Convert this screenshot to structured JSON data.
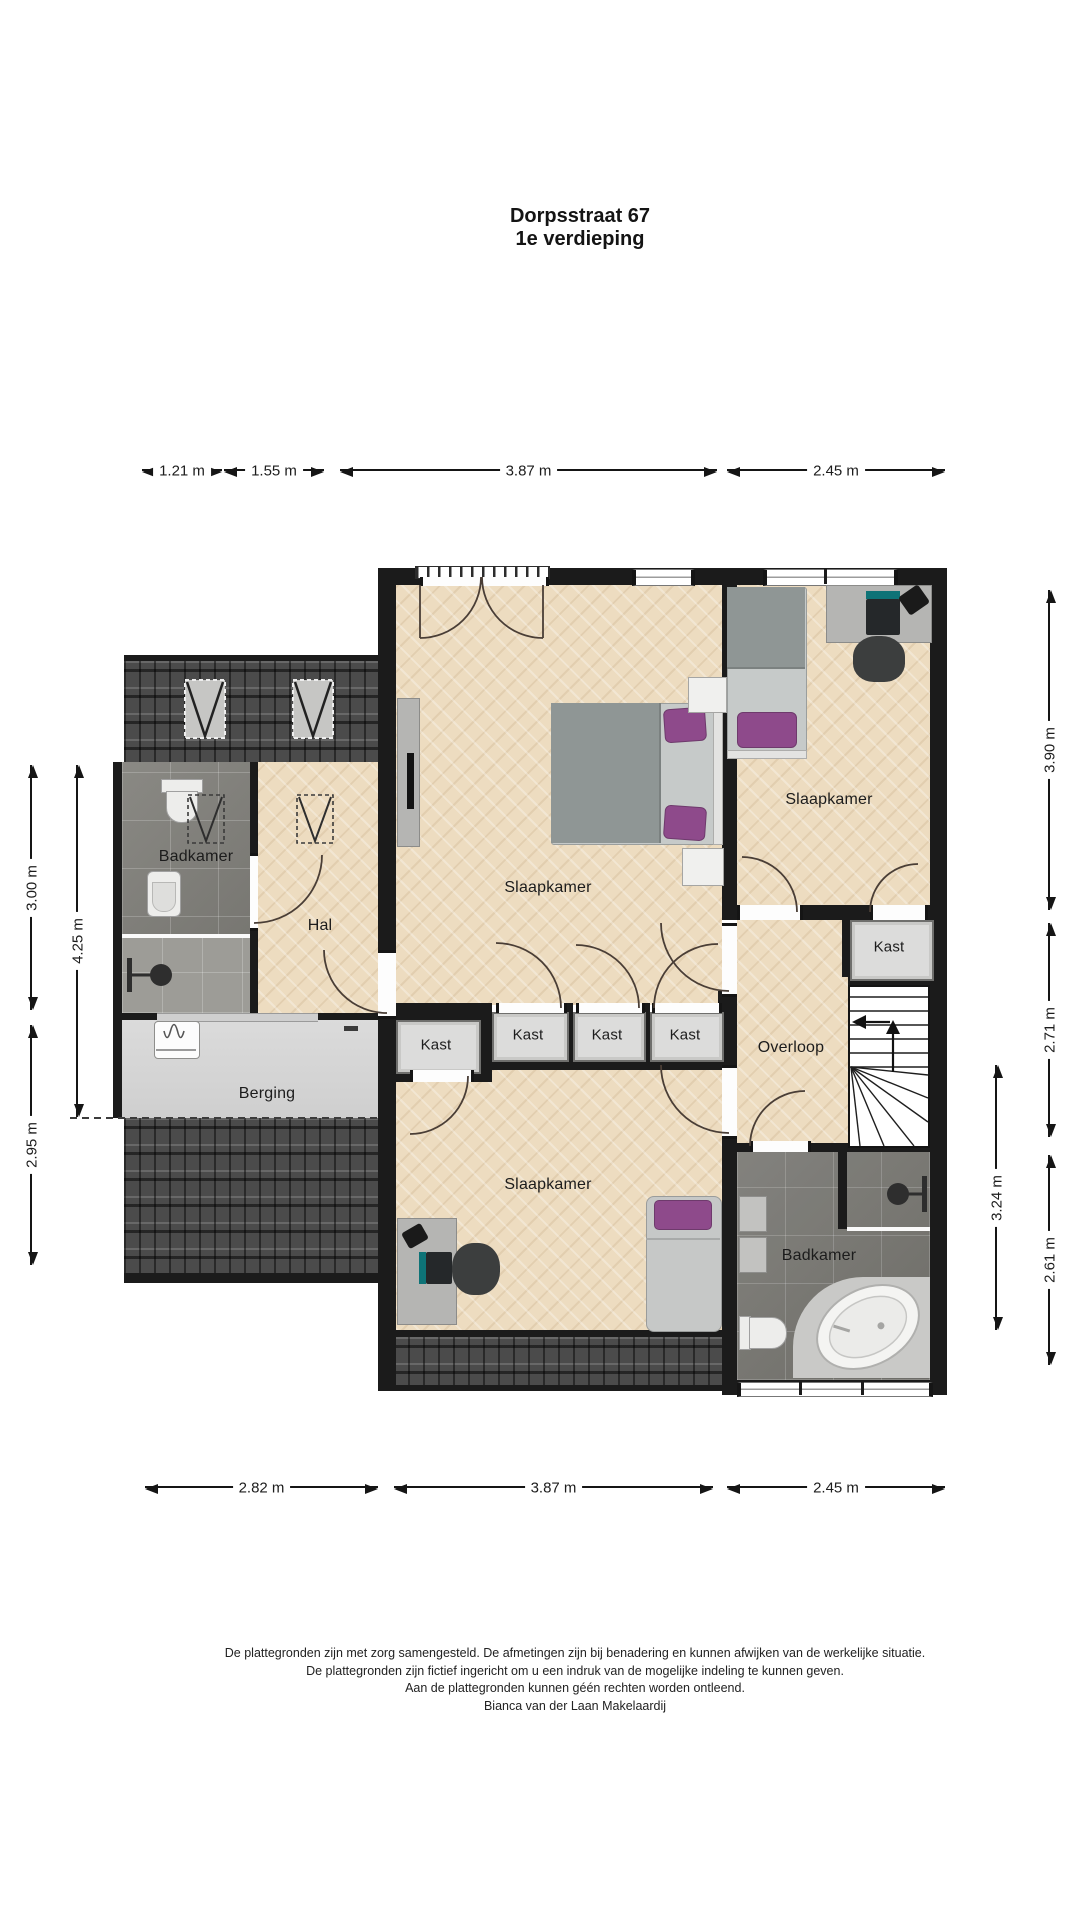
{
  "title": {
    "line1": "Dorpsstraat 67",
    "line2": "1e verdieping"
  },
  "rooms": {
    "bedroom_main": "Slaapkamer",
    "bedroom_right": "Slaapkamer",
    "bedroom_bottom": "Slaapkamer",
    "bathroom_left": "Badkamer",
    "bathroom_right": "Badkamer",
    "hall": "Hal",
    "storage": "Berging",
    "landing": "Overloop",
    "closets": [
      "Kast",
      "Kast",
      "Kast",
      "Kast",
      "Kast"
    ]
  },
  "dimensions": {
    "top": [
      "1.21 m",
      "1.55 m",
      "3.87 m",
      "2.45 m"
    ],
    "bottom": [
      "2.82 m",
      "3.87 m",
      "2.45 m"
    ],
    "left": [
      "3.00 m",
      "4.25 m",
      "2.95 m"
    ],
    "right": [
      "3.90 m",
      "2.71 m",
      "2.61 m",
      "3.24 m"
    ]
  },
  "footer": [
    "De plattegronden zijn met zorg samengesteld. De afmetingen zijn bij benadering en kunnen afwijken van de werkelijke situatie.",
    "De plattegronden zijn fictief ingericht om u een indruk van de mogelijke indeling te kunnen geven.",
    "Aan de plattegronden kunnen géén rechten worden ontleend.",
    "Bianca van der Laan Makelaardij"
  ],
  "colors": {
    "wall": "#1b1b1b",
    "wood_floor": "#eddcc0",
    "tile_dark": "#7f7e79",
    "tile_light": "#9d9c97",
    "gray_floor": "#d6d6d6",
    "roof": "#4b4b4b",
    "closet_fill": "#dcdcdb",
    "accent_purple": "#8e4a8b"
  }
}
